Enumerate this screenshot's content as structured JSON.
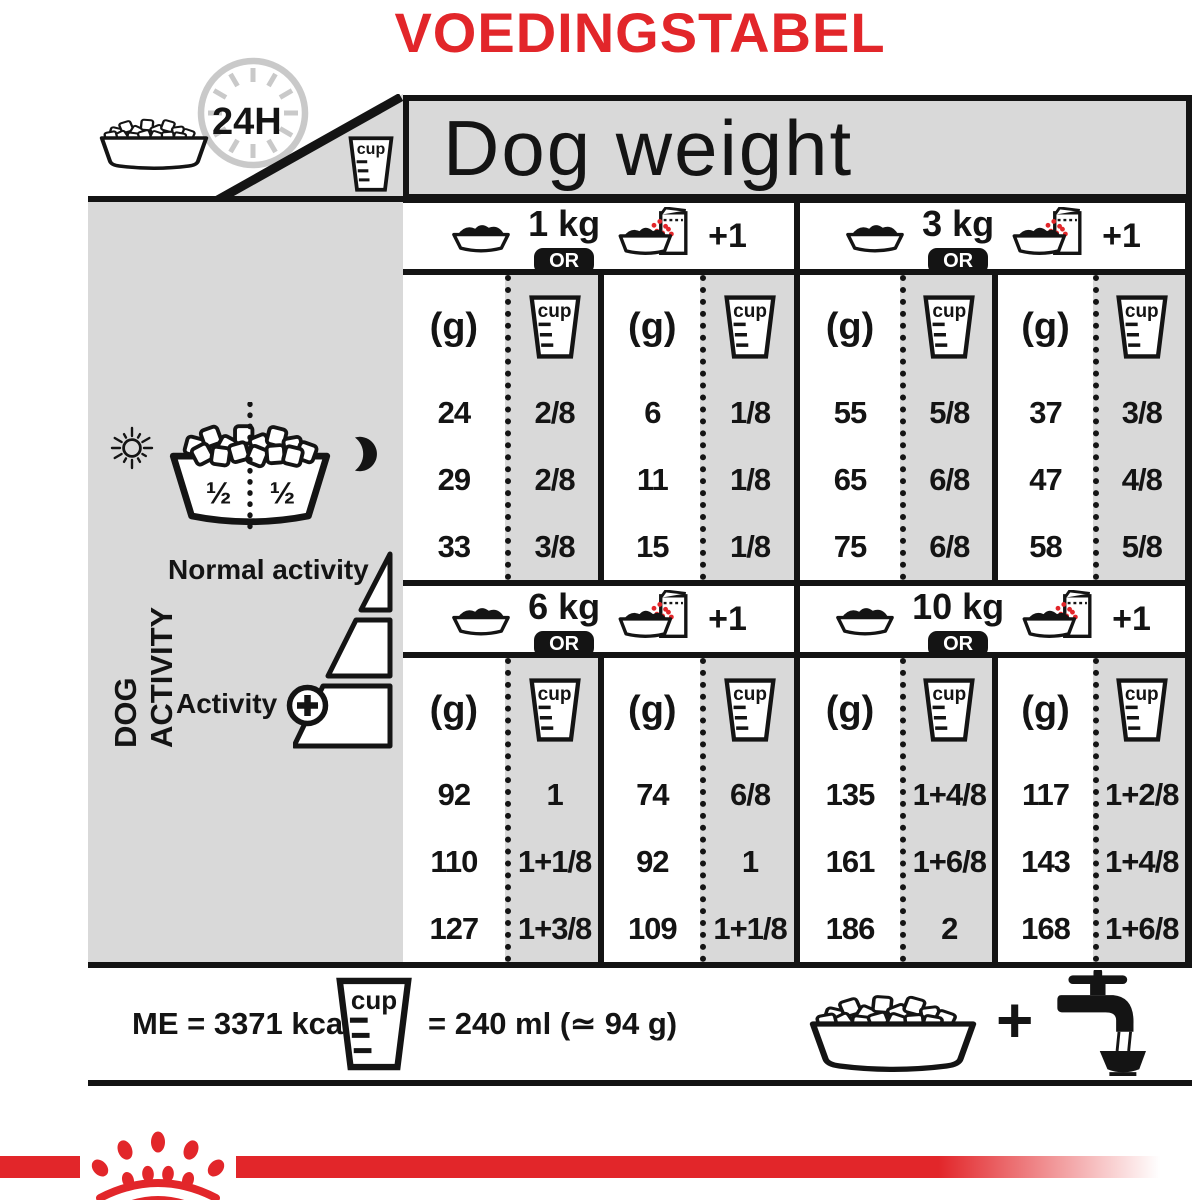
{
  "title": "VOEDINGSTABEL",
  "top_icons": {
    "clock_label": "24H"
  },
  "header": {
    "dog_weight": "Dog weight"
  },
  "labels": {
    "cup": "cup",
    "gram": "(g)",
    "or": "OR",
    "plus_one": "+1",
    "plus": "+"
  },
  "sidebar": {
    "dog_activity": "DOG ACTIVITY",
    "half_left": "½",
    "half_right": "½",
    "normal_activity": "Normal activity",
    "activity": "Activity"
  },
  "blocks": [
    {
      "weight": "1 kg",
      "rows": [
        [
          "24",
          "2/8",
          "6",
          "1/8"
        ],
        [
          "29",
          "2/8",
          "11",
          "1/8"
        ],
        [
          "33",
          "3/8",
          "15",
          "1/8"
        ]
      ]
    },
    {
      "weight": "3 kg",
      "rows": [
        [
          "55",
          "5/8",
          "37",
          "3/8"
        ],
        [
          "65",
          "6/8",
          "47",
          "4/8"
        ],
        [
          "75",
          "6/8",
          "58",
          "5/8"
        ]
      ]
    },
    {
      "weight": "6 kg",
      "rows": [
        [
          "92",
          "1",
          "74",
          "6/8"
        ],
        [
          "110",
          "1+1/8",
          "92",
          "1"
        ],
        [
          "127",
          "1+3/8",
          "109",
          "1+1/8"
        ]
      ]
    },
    {
      "weight": "10 kg",
      "rows": [
        [
          "135",
          "1+4/8",
          "117",
          "1+2/8"
        ],
        [
          "161",
          "1+6/8",
          "143",
          "1+4/8"
        ],
        [
          "186",
          "2",
          "168",
          "1+6/8"
        ]
      ]
    }
  ],
  "footer": {
    "me": "ME = 3371 kcal/kg",
    "cup_equiv": "= 240 ml (≃ 94 g)"
  },
  "colors": {
    "red": "#e2262a",
    "gray": "#d9d9d9",
    "black": "#141414"
  }
}
